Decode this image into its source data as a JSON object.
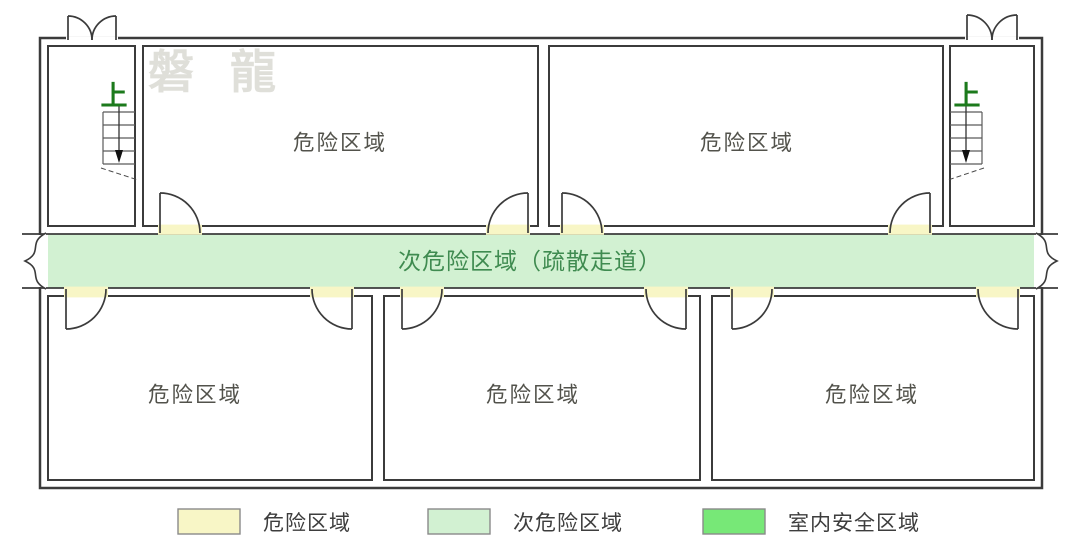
{
  "watermark": "磐 龍",
  "colors": {
    "hazard_zone": "#f8f6c6",
    "secondary_zone": "#d2f1d2",
    "safe_zone": "#77e877",
    "wall_outline": "#3b3b3b",
    "white": "#ffffff"
  },
  "rooms": [
    {
      "id": "top-left",
      "label": "危险区域"
    },
    {
      "id": "top-right",
      "label": "危险区域"
    },
    {
      "id": "bottom-left",
      "label": "危险区域"
    },
    {
      "id": "bottom-middle",
      "label": "危险区域"
    },
    {
      "id": "bottom-right",
      "label": "危险区域"
    }
  ],
  "corridor": {
    "label": "次危险区域（疏散走道）"
  },
  "stairwells": [
    {
      "id": "left",
      "up_label": "上"
    },
    {
      "id": "right",
      "up_label": "上"
    }
  ],
  "legend": [
    {
      "label": "危险区域",
      "color": "#f8f6c6"
    },
    {
      "label": "次危险区域",
      "color": "#d2f1d2"
    },
    {
      "label": "室内安全区域",
      "color": "#77e877"
    }
  ]
}
